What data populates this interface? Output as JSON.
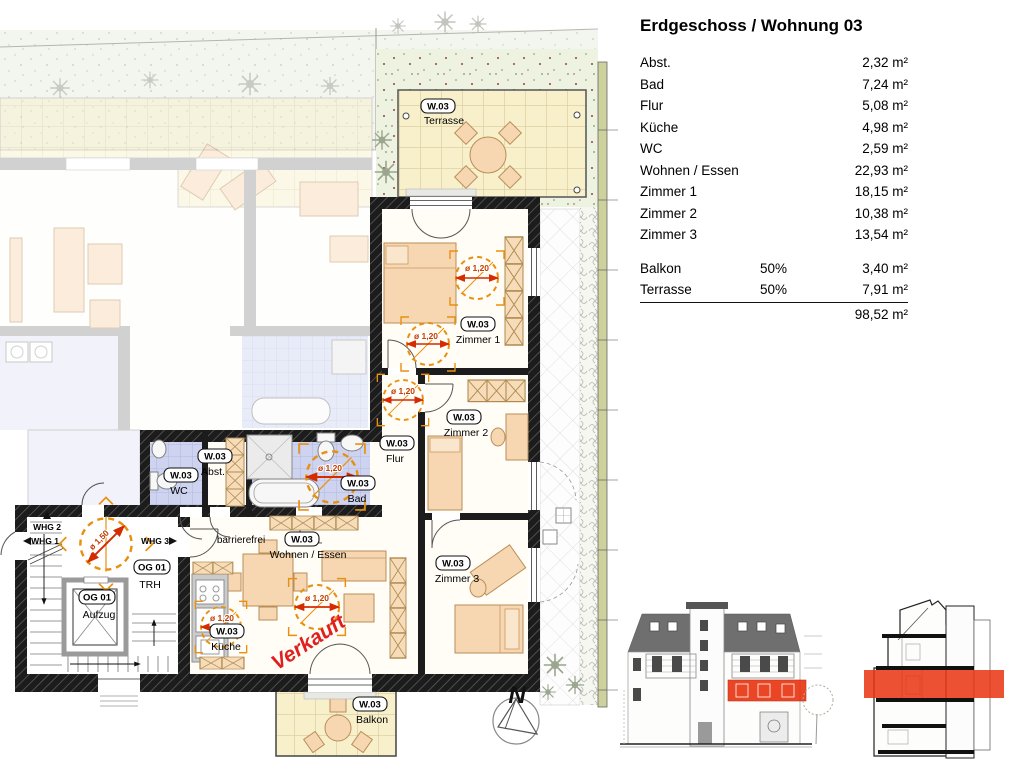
{
  "title": "Erdgeschoss / Wohnung 03",
  "area_table": {
    "rows": [
      {
        "label": "Abst.",
        "value": "2,32 m²"
      },
      {
        "label": "Bad",
        "value": "7,24 m²"
      },
      {
        "label": "Flur",
        "value": "5,08 m²"
      },
      {
        "label": "Küche",
        "value": "4,98 m²"
      },
      {
        "label": "WC",
        "value": "2,59 m²"
      },
      {
        "label": "Wohnen / Essen",
        "value": "22,93 m²"
      },
      {
        "label": "Zimmer 1",
        "value": "18,15 m²"
      },
      {
        "label": "Zimmer 2",
        "value": "10,38 m²"
      },
      {
        "label": "Zimmer 3",
        "value": "13,54 m²"
      }
    ],
    "outdoor_rows": [
      {
        "label": "Balkon",
        "share": "50%",
        "value": "3,40 m²"
      },
      {
        "label": "Terrasse",
        "share": "50%",
        "value": "7,91 m²"
      }
    ],
    "total": "98,52 m²"
  },
  "plan": {
    "unit_tag": "W.03",
    "rooms": {
      "terrasse": "Terrasse",
      "zimmer1": "Zimmer 1",
      "zimmer2": "Zimmer 2",
      "zimmer3": "Zimmer 3",
      "flur": "Flur",
      "abst": "Abst.",
      "wc": "WC",
      "bad": "Bad",
      "wohnen_essen": "Wohnen / Essen",
      "kueche": "Küche",
      "balkon": "Balkon"
    },
    "stairwell": {
      "floor_tag": "OG 01",
      "trh": "TRH",
      "aufzug": "Aufzug"
    },
    "neighbor_units": {
      "whg1": "WHG 1",
      "whg2": "WHG 2",
      "whg3": "WHG 3"
    },
    "annotations": {
      "barrierefrei": "barrierefrei",
      "verkauft": "Verkauft",
      "circle_120": "ø 1,20",
      "circle_150": "ø 1,50"
    },
    "north_label": "N"
  },
  "colors": {
    "sold_red": "#e02020",
    "highlight_red": "#e8330e",
    "turning_circle_orange": "#e89010",
    "wall_black": "#1a1a1a",
    "bath_tile_blue": "#ced3f0",
    "terrace_tile_cream": "#f8f0cb",
    "garden_green": "#edf3e0"
  }
}
